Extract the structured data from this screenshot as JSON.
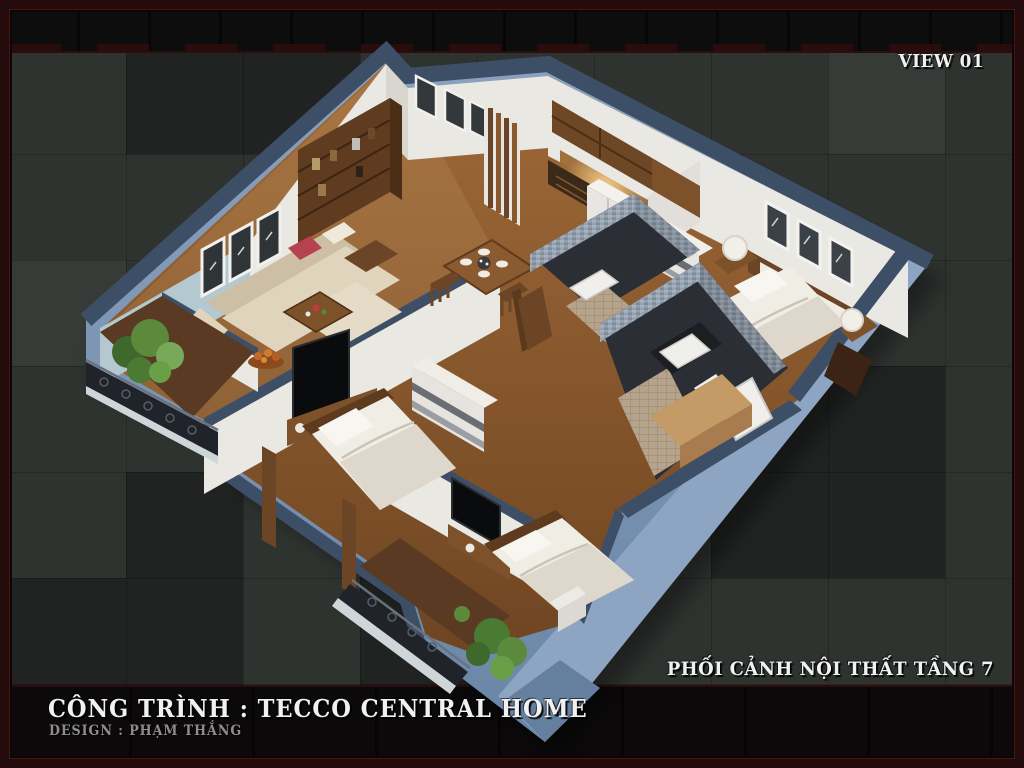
{
  "header": {
    "view_label": "VIEW 01"
  },
  "captions": {
    "floor_view": "PHỐI CẢNH NỘI THẤT TẦNG 7"
  },
  "footer": {
    "project": "CÔNG TRÌNH : TECCO CENTRAL HOME",
    "designer": "DESIGN : PHẠM THẮNG"
  },
  "colors": {
    "frame_maroon": "#240b0b",
    "frame_line": "#471717",
    "band_black": "#0b0b0b",
    "bg_base": "#2f3330",
    "text_white": "#f1f1f1",
    "text_gray": "#8f8c8c",
    "wall_navy": "#3d4f66",
    "wall_blue_mid": "#7690b1",
    "wall_blue_light": "#8da5c2",
    "wall_white": "#eae8e3",
    "aqua_wall": "#b4c9cf",
    "wood_floor": "#96622f",
    "wood_dark": "#5e3b1e",
    "wood_mid": "#7d5129",
    "wood_light": "#c49a66",
    "sofa_cream": "#e0d4bd",
    "bed_white": "#f0ede5",
    "tv_black": "#0a0b0d",
    "mosaic_gray": "#97a3b1",
    "bath_dark": "#2b2e34",
    "tile_tan": "#b5a38b",
    "plant_green": "#5c8a3c",
    "accent_red": "#b5434f",
    "glow_warm": "#e9b469",
    "rail_dark": "#20242a"
  }
}
